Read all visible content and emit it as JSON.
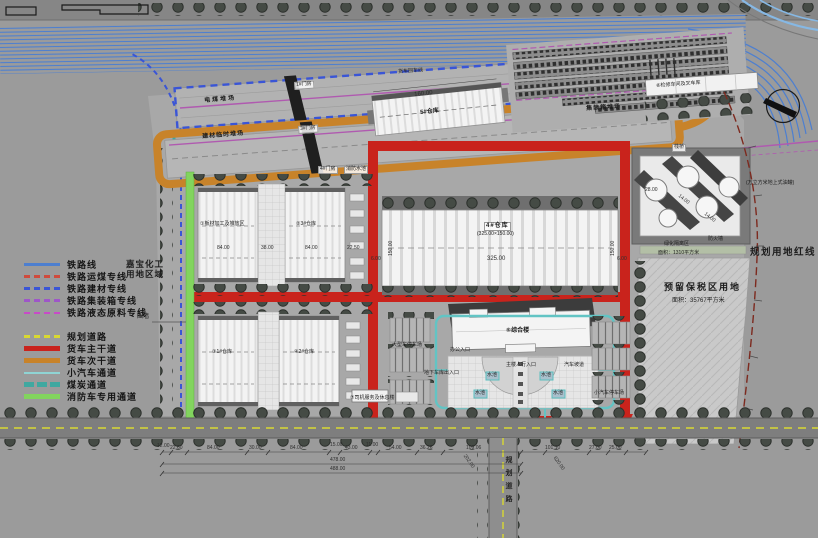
{
  "colors": {
    "background": "#9b9b9b",
    "railway_blue": "#4d7fd0",
    "coal_rail_red": "#cf4b3d",
    "material_rail_blue": "#3a55d6",
    "container_rail_purple": "#9e56c8",
    "liquid_rail_magenta": "#c84bc8",
    "planned_road_yellow": "#d8d832",
    "truck_main_red": "#c9231c",
    "truck_secondary_orange": "#c8832a",
    "car_lane_cyan": "#8fd4d4",
    "coal_lane_teal": "#3fa8a0",
    "fire_lane_green": "#82d45e"
  },
  "legend": {
    "rail": [
      "铁路线",
      "铁路运煤专线",
      "铁路建材专线",
      "铁路集装箱专线",
      "铁路液态原料专线"
    ],
    "road": [
      "规划道路",
      "货车主干道",
      "货车次干道",
      "小汽车通道",
      "煤炭通道",
      "消防车专用通道"
    ]
  },
  "labels": {
    "jiabao": "嘉宝化工\n用地区域",
    "wall": "围墙",
    "coal_yard": "电煤堆场",
    "material_yard": "建材临时堆场",
    "container_yard": "集装箱堆场",
    "truck_return": "货车回车线",
    "gate1": "1#门房",
    "gate3": "3#门房",
    "gate4": "4#门房",
    "fire_pool": "消防水池",
    "trestle": "栈桥",
    "workshop": "⑥检修车间及叉车库",
    "tank_note": "(万立方米地上式油罐)",
    "red_line": "规划用地红线",
    "green_buffer": "绿化隔离区",
    "green_buffer_area": "面积：1310平方米",
    "firewall": "防火墙",
    "bonded_title": "预留保税区用地",
    "bonded_area": "面积：35767平方米",
    "b1": "①板材加工及堆放区",
    "b2": "②3#仓库",
    "b3": "③1#仓库",
    "b4": "④2#仓库",
    "b5": "5#仓库",
    "big": "4#仓库",
    "big_size": "(325.00×150.00)",
    "office": "⑤综合楼",
    "office_entry": "办公入口",
    "main_entry": "主楼人行入口",
    "ramp": "汽车坡道",
    "underground": "地下车库出入口",
    "pool": "水池",
    "truck_parking": "大型车停车场",
    "car_parking": "小汽车停车场",
    "driver": "⑦司机服务及休息楼",
    "planned_road_v": "规划道路"
  },
  "dims": {
    "d160": "160.00",
    "row_mid": [
      "84.00",
      "38.00",
      "84.00",
      "22.50"
    ],
    "big_w": "325.00",
    "big_h": "150.00",
    "big_m": "6.00",
    "tank": [
      "28.00",
      "14.00",
      "14.00"
    ],
    "bottom": [
      "12.00",
      "22.60",
      "84.00",
      "30.00",
      "84.00",
      "15.00",
      "43.00",
      "11.00",
      "54.00",
      "36.26",
      "109.06"
    ],
    "bottom_right": [
      "101.10",
      "27.00",
      "25.00"
    ],
    "total1": "478.00",
    "total2": "488.00",
    "diag": [
      "202.00",
      "620.00"
    ]
  }
}
